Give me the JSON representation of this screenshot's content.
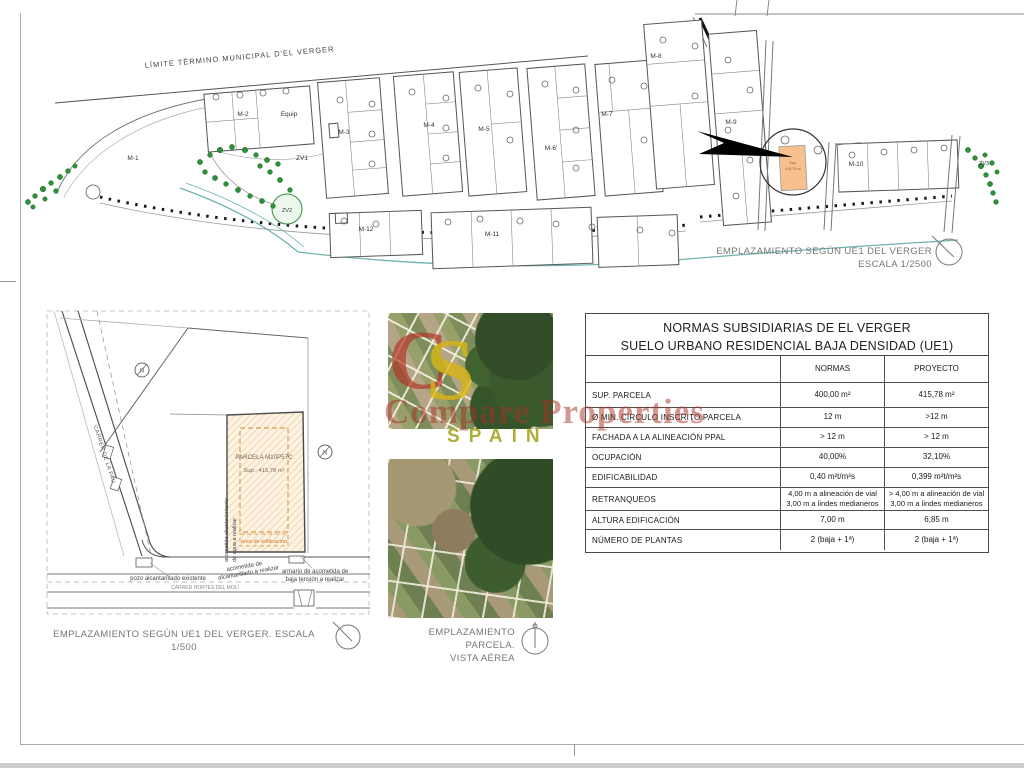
{
  "site_plan": {
    "boundary_label": "LÍMITE TÉRMINO MUNICIPAL D'EL VERGER",
    "labels": {
      "m1": "M-1",
      "m2": "M-2",
      "m3": "M-3",
      "m4": "M-4",
      "m5": "M-5",
      "m6p": "M-6'",
      "m7": "M-7",
      "m8": "M-8",
      "m9": "M-9",
      "m10": "M-10",
      "m11": "M-11",
      "m12": "M-12",
      "equip": "Equip",
      "zv1": "ZV1",
      "zv2": "ZV2",
      "zv3": "ZV3"
    },
    "highlight": {
      "l1": "Sup.",
      "l2": "415,78 m²"
    },
    "caption_line1": "EMPLAZAMIENTO SEGÚN  UE1 DEL VERGER",
    "caption_line2": "ESCALA 1/2500"
  },
  "detail_plan": {
    "parcel_title": "PARCELA M10P57C",
    "parcel_area": "Sup.:  415,78 m²",
    "building_area_label": "área de edificación",
    "street_left": "CARRER DE LA PAU",
    "street_bottom": "CARRER HORTES DEL MOLÍ",
    "north_letter": "N",
    "ann_sewer_existing": "pozo alcantarillado existente",
    "ann_sewer_new_l1": "acometida de",
    "ann_sewer_new_l2": "alcantarillado a realizar",
    "ann_water_l1": "acometida abastecimiento",
    "ann_water_l2": "de agua a realizar",
    "ann_electric_l1": "armario de acometida de",
    "ann_electric_l2": "baja tensión a realizar",
    "caption": "EMPLAZAMIENTO SEGÚN  UE1 DEL VERGER. ESCALA 1/500"
  },
  "aerial": {
    "caption_line1": "EMPLAZAMIENTO PARCELA.",
    "caption_line2": "VISTA AÉREA"
  },
  "table": {
    "title_line1": "NORMAS SUBSIDIARIAS DE EL VERGER",
    "title_line2": "SUELO URBANO RESIDENCIAL BAJA DENSIDAD (UE1)",
    "col_normas": "NORMAS",
    "col_proyecto": "PROYECTO",
    "rows": [
      {
        "label": "SUP. PARCELA",
        "normas": "400,00 m²",
        "proyecto": "415,78 m²"
      },
      {
        "label": "Ø MIN. CÍRCULO  INSCRITO PARCELA",
        "normas": "12 m",
        "proyecto": ">12 m"
      },
      {
        "label": "FACHADA A LA ALINEACIÓN PPAL",
        "normas": "> 12 m",
        "proyecto": "> 12 m"
      },
      {
        "label": "OCUPACIÓN",
        "normas": "40,00%",
        "proyecto": "32,10%"
      },
      {
        "label": "EDIFICABILIDAD",
        "normas": "0,40 m²t/m²s",
        "proyecto": "0,399 m²t/m²s"
      },
      {
        "label": "RETRANQUEOS",
        "normas": "4,00 m a alineación de vial\n3,00 m a lindes medianeros",
        "proyecto": "> 4,00 m a alineación de vial\n3,00 m a lindes medianeros"
      },
      {
        "label": "ALTURA EDIFICACIÓN",
        "normas": "7,00 m",
        "proyecto": "6,85 m"
      },
      {
        "label": "NÚMERO DE PLANTAS",
        "normas": "2 (baja + 1ª)",
        "proyecto": "2 (baja + 1ª)"
      }
    ]
  },
  "watermark": {
    "monogram_c": "C",
    "monogram_s": "S",
    "text": "Compare Properties",
    "country": "SPAIN",
    "red": "#a83226",
    "yellow": "#d9b514"
  },
  "colors": {
    "highlight_fill": "#f6c08f",
    "hatch_line": "#ecc496",
    "tree_green": "#2f8f3a",
    "teal_line": "#6fb3ae"
  }
}
